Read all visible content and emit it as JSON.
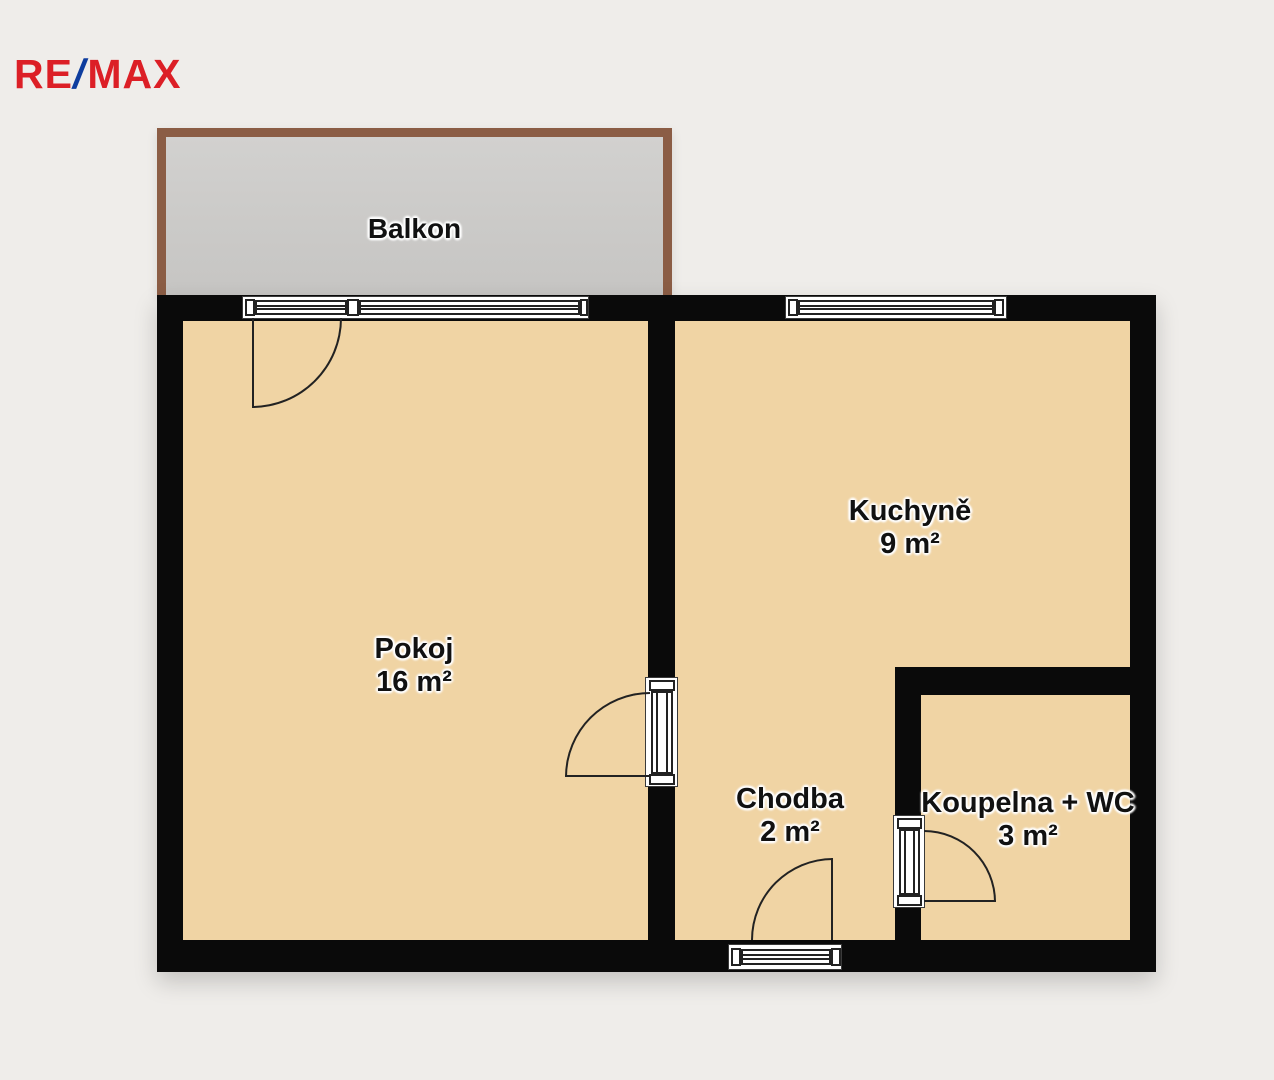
{
  "logo": {
    "re": "RE",
    "slash": "/",
    "max": "MAX"
  },
  "balcony": {
    "name": "Balkon"
  },
  "rooms": {
    "pokoj": {
      "name": "Pokoj",
      "area": "16 m²"
    },
    "kuchyne": {
      "name": "Kuchyně",
      "area": "9 m²"
    },
    "chodba": {
      "name": "Chodba",
      "area": "2 m²"
    },
    "koupelna": {
      "name": "Koupelna + WC",
      "area": "3 m²"
    }
  },
  "colors": {
    "background": "#efedea",
    "wall": "#0a0a0a",
    "room": "#f0d4a4",
    "balcony_floor": "#cbcac8",
    "balcony_border": "#8b5d45",
    "line": "#222222",
    "window": "#ffffff",
    "text": "#111111",
    "logo_red": "#dc1f26",
    "logo_blue": "#0e3d9e"
  }
}
